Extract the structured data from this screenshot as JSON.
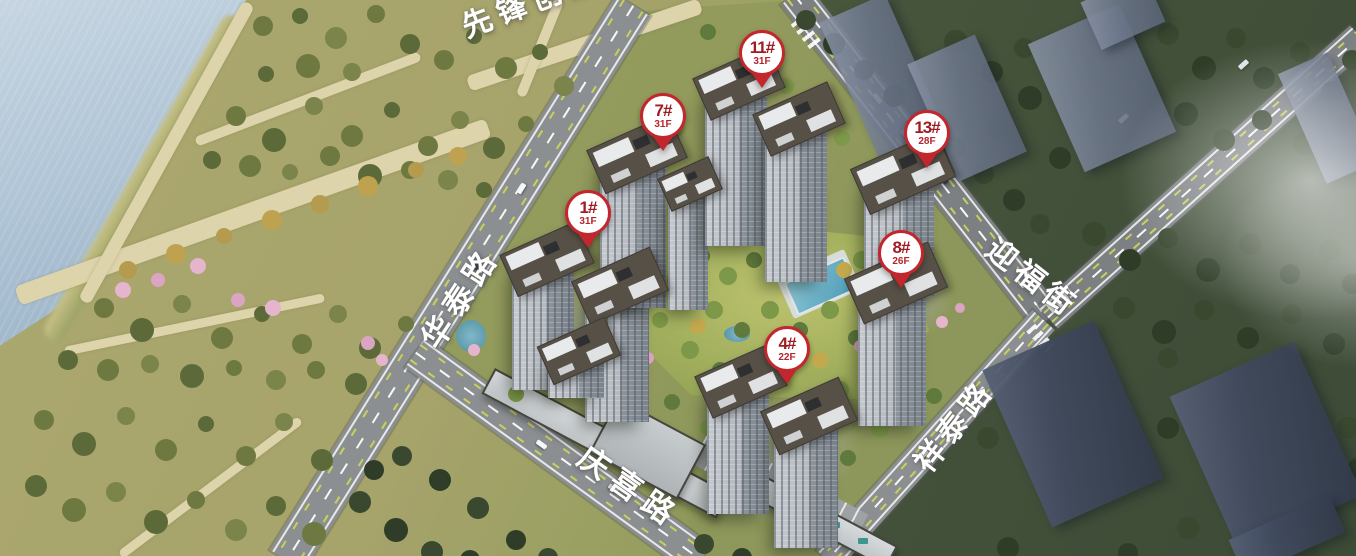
{
  "scene": {
    "description": "Aerial masterplan rendering of a riverside residential development with numbered building pins and road name labels",
    "colors": {
      "pin_red": "#c1272d",
      "pin_number_text": "#9e1c23",
      "pin_floor_text": "#b6242b",
      "water_blue": "#a9bfd3",
      "road_gray": "#8b8f92",
      "park_olive": "#a6a36b",
      "dark_tree_green": "#3a4830",
      "label_white": "#ffffff"
    }
  },
  "building_pins": [
    {
      "label": "11#",
      "floors": "31F"
    },
    {
      "label": "7#",
      "floors": "31F"
    },
    {
      "label": "13#",
      "floors": "28F"
    },
    {
      "label": "1#",
      "floors": "31F"
    },
    {
      "label": "8#",
      "floors": "26F"
    },
    {
      "label": "4#",
      "floors": "22F"
    }
  ],
  "road_labels": [
    {
      "text": "先锋创意"
    },
    {
      "text": "华泰路"
    },
    {
      "text": "迎福街"
    },
    {
      "text": "祥泰路"
    },
    {
      "text": "庆喜路"
    }
  ]
}
